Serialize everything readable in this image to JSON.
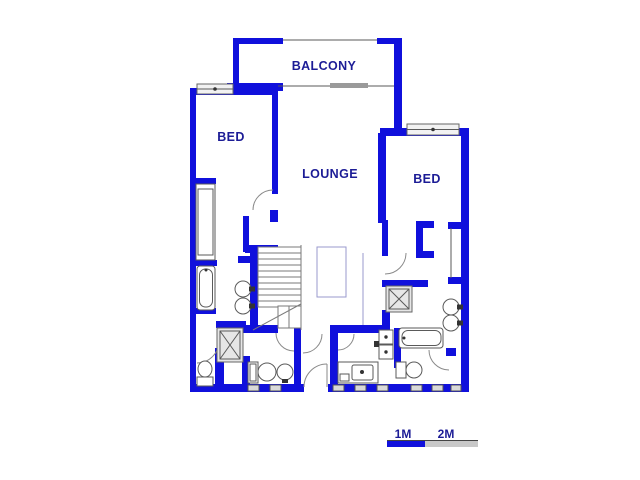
{
  "floor_plan": {
    "rooms": {
      "balcony": "BALCONY",
      "bed_left": "BED",
      "lounge": "LOUNGE",
      "bed_right": "BED"
    }
  },
  "scale_bar": {
    "one_meter": "1M",
    "two_meters": "2M"
  },
  "colors": {
    "wall": "#1010dc",
    "room_label": "#1c1c96",
    "scale_blue": "#1010dc",
    "scale_gray": "#c8c8c8"
  }
}
